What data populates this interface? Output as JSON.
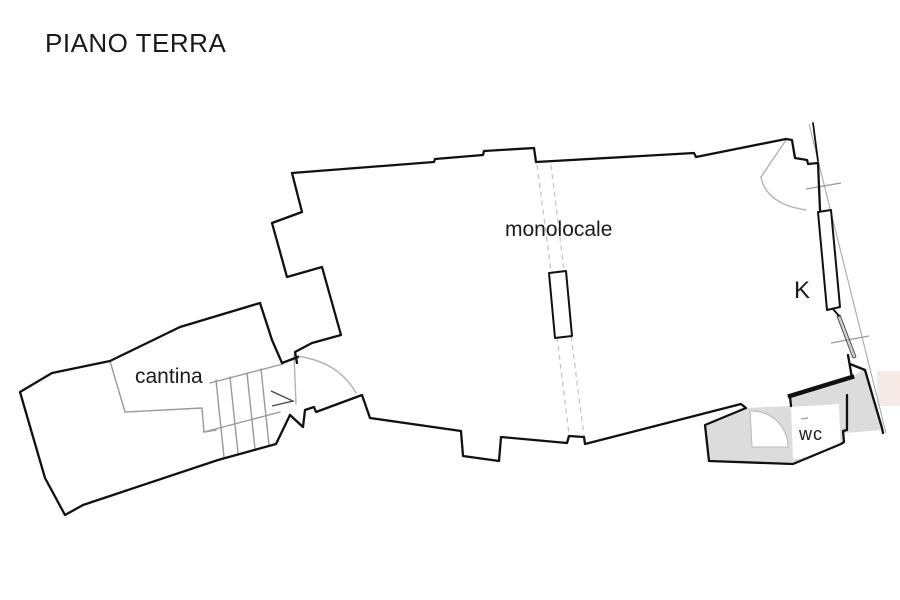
{
  "title": "PIANO TERRA",
  "labels": {
    "monolocale": "monolocale",
    "cantina": "cantina",
    "kitchen": "K",
    "wc": "wc"
  },
  "floor_plan": {
    "floor": "ground floor",
    "rooms": [
      {
        "id": "monolocale",
        "label": "monolocale",
        "type": "studio room"
      },
      {
        "id": "cantina",
        "label": "cantina",
        "type": "cellar with staircase"
      },
      {
        "id": "kitchen",
        "label": "K",
        "type": "kitchen niche"
      },
      {
        "id": "wc",
        "label": "wc",
        "type": "bathroom, gray filled"
      }
    ],
    "symbols": [
      "door-swing-arcs",
      "staircase-with-direction-arrow",
      "window-on-right-wall",
      "dashed-ceiling-beam-lines",
      "pillar",
      "boundary-line",
      "survey-tick-marks"
    ]
  },
  "colors": {
    "wall": "#111111",
    "annotation": "#999999",
    "light": "#c6c6c6",
    "room_fill": "#dcdcdc",
    "highlight_fill": "#f7e9e6",
    "background": "#ffffff",
    "text": "#1a1a1a"
  }
}
